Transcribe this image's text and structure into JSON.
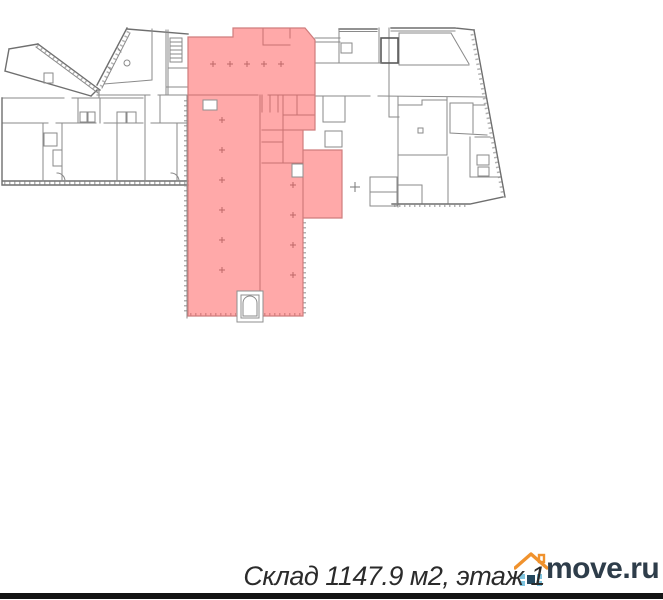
{
  "caption": {
    "text": "Склад 1147.9 м2, этаж 1"
  },
  "watermark": {
    "text": "move.ru",
    "icon": "house-icon"
  },
  "plan": {
    "type": "floor-plan",
    "highlighted_area": "warehouse-selection",
    "features": [
      "building-walls",
      "highlighted-warehouse-area",
      "elevator-shaft",
      "stairs-symbol",
      "column-marks"
    ]
  },
  "colors": {
    "highlight": "#ff5a5a",
    "plan_line": "#8a8a8a",
    "plan_line_dark": "#6f6f6f",
    "caption_text": "#2b2b2b",
    "logo_text": "#2e3d4a",
    "logo_roof": "#f0922d",
    "logo_square_light": "#7fc5e0",
    "logo_square_dark": "#25495f",
    "bottom_bar": "#141414"
  }
}
